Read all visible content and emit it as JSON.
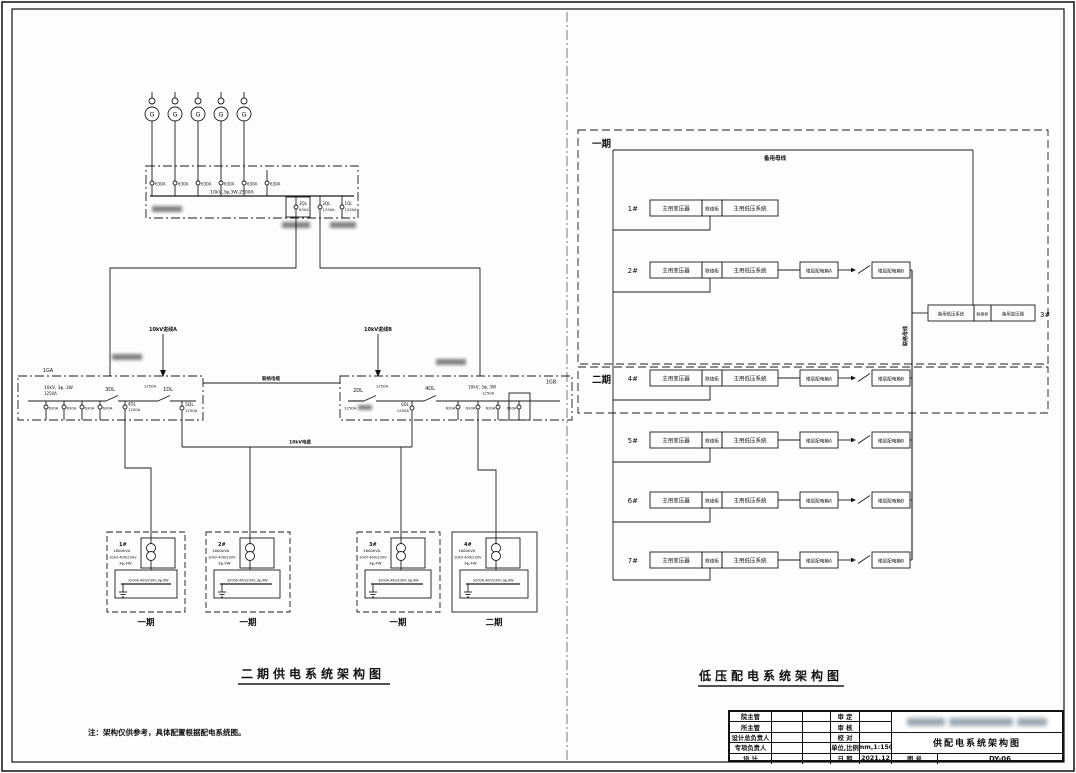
{
  "left_diagram": {
    "title": "二期供电系统架构图",
    "note": "注：架构仅供参考，具体配置根据配电系统图。",
    "generators": {
      "symbol": "G"
    },
    "gen_bus": {
      "breakers": [
        "630A",
        "630A",
        "630A",
        "630A",
        "630A",
        "630A"
      ],
      "spec": "10kV,3φ,3W,2500A",
      "ql3": "3QL",
      "ql3_amp": "630A",
      "ql2": "2QL",
      "ql2_amp": "1250A",
      "ql1": "1QL",
      "ql1_amp": "1250A"
    },
    "feeder_a": "10kV进线A",
    "feeder_b": "10kV进线B",
    "tie_upper": "联络电缆",
    "tie_lower": "10kV电缆",
    "bus_a": {
      "name": "1GA",
      "spec": "10kV, 3φ, 3W",
      "amp": "1250A",
      "dl3": "3DL",
      "dl1": "1DL",
      "dl1_amp": "1250A",
      "dl4": "4DL",
      "dl4_amp": "1250A",
      "dl5": "5DL",
      "dl5_amp": "1250A",
      "feeder_amp": "630A"
    },
    "bus_b": {
      "name": "1GB",
      "spec": "10kV, 3φ, 3W",
      "amp": "1250A",
      "dl2": "2DL",
      "dl2_amp": "1250A",
      "dl4": "4DL",
      "dl6": "6DL",
      "dl6_amp": "1250A",
      "feeder_amp": "630A"
    },
    "transformers": [
      {
        "no": "1#",
        "kva": "1600kVA",
        "ratio": "10kV-400/230V",
        "wiring": "3φ,4W",
        "bus": "3200A,400/230V,3φ,4W",
        "phase": "一期"
      },
      {
        "no": "2#",
        "kva": "1600kVA",
        "ratio": "10kV-400/230V",
        "wiring": "3φ,4W",
        "bus": "3200A,400/230V,3φ,4W",
        "phase": "一期"
      },
      {
        "no": "3#",
        "kva": "1600kVA",
        "ratio": "10kV-400/230V",
        "wiring": "3φ,4W",
        "bus": "3200A,400/230V,3φ,4W",
        "phase": "一期"
      },
      {
        "no": "4#",
        "kva": "1600kVA",
        "ratio": "10kV-400/230V",
        "wiring": "3φ,4W",
        "bus": "3200A,400/230V,3φ,4W",
        "phase": "二期"
      }
    ]
  },
  "right_diagram": {
    "title": "低压配电系统架构图",
    "phase1": "一期",
    "phase2": "二期",
    "top_bus": "备用母线",
    "tie_bus": "联络母线",
    "main_t": "主用变压器",
    "tie_cab": "联络柜",
    "main_lv": "主用低压系统",
    "box_a": "楼层配电箱A",
    "box_b": "楼层配电箱B",
    "rows": [
      {
        "no": "1#"
      },
      {
        "no": "2#"
      },
      {
        "no": "4#"
      },
      {
        "no": "5#"
      },
      {
        "no": "6#"
      },
      {
        "no": "7#"
      }
    ],
    "backup": {
      "no": "3#",
      "lv": "备用低压系统",
      "tie": "联络柜",
      "t": "备用变压器"
    }
  },
  "title_block": {
    "left_labels": [
      "院主管",
      "所主管",
      "设计总负责人",
      "专项负责人",
      "设  计"
    ],
    "mid_labels": [
      "审  定",
      "审  核",
      "校  对",
      "单位,比例",
      "日  期"
    ],
    "mid_values": [
      "",
      "",
      "",
      "mm,1:150",
      "2021.12"
    ],
    "drawing_title": "供配电系统架构图",
    "fig_label": "图  号",
    "fig_no": "DY-06"
  }
}
